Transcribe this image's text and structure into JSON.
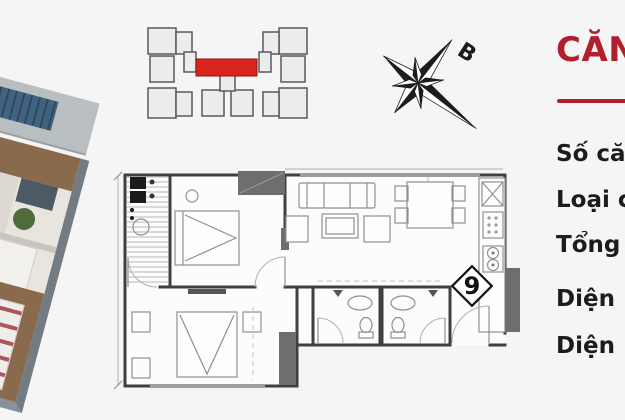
{
  "colors": {
    "background": "#f5f5f5",
    "accent_red": "#b0202c",
    "highlight_red": "#d9251d",
    "text": "#1c1c1c",
    "wall": "#3f3f3f",
    "furniture_line": "#909090",
    "dark_fill": "#6e6e6e"
  },
  "compass": {
    "north_label": "B"
  },
  "info_panel": {
    "title": "CĂN",
    "items": [
      "Số căn",
      "Loại c",
      "Tổng",
      "Diện",
      "Diện"
    ]
  },
  "floor_plan": {
    "unit_badge": "9"
  }
}
